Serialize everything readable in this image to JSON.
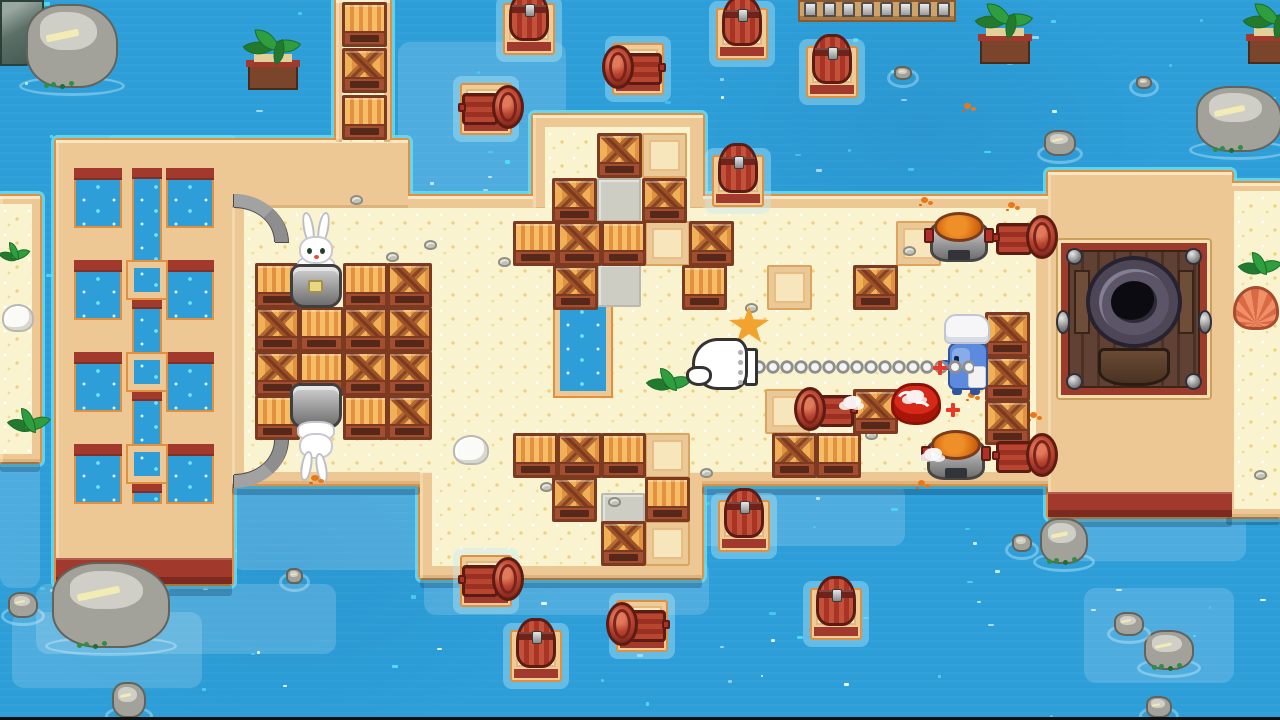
{
  "scene": {
    "w": 1280,
    "h": 720,
    "name": "beach-arena-map",
    "letterbox_bottom": 3
  },
  "palette": {
    "water": "#2d9ed8",
    "water_sparkle": "#4fdef6",
    "water_sparkle_white": "#eafcff",
    "aqua_rim": "rgba(108,220,240,0.85)",
    "outline_orange": "#e0903e",
    "tan": "#edc794",
    "sand": "#faf3d0",
    "dark_red": "#a13a2c",
    "crate_frame": "#7c3a20",
    "crate_light": "#f4bd66",
    "crate_dark": "#e39140",
    "barrel_red": "#a93426",
    "grey_tile": "#cdcdc3",
    "metal": "#9e9e9e"
  },
  "ocean": {
    "sparkle_count": 175,
    "seed": 13
  },
  "shallows": [
    [
      36,
      584,
      300,
      70
    ],
    [
      12,
      612,
      190,
      76
    ],
    [
      424,
      560,
      285,
      55
    ],
    [
      1046,
      506,
      200,
      55
    ],
    [
      1084,
      588,
      150,
      95
    ],
    [
      398,
      42,
      168,
      150
    ],
    [
      232,
      470,
      205,
      100
    ],
    [
      690,
      484,
      215,
      62
    ],
    [
      0,
      458,
      40,
      130
    ]
  ],
  "land": {
    "shapes": [
      {
        "n": "main-island",
        "x": 232,
        "y": 196,
        "w": 816,
        "h": 288
      },
      {
        "n": "bridge-band",
        "x": 112,
        "y": 140,
        "w": 296,
        "h": 68
      },
      {
        "n": "upper-block",
        "x": 533,
        "y": 115,
        "w": 170,
        "h": 95
      },
      {
        "n": "lower-block",
        "x": 420,
        "y": 470,
        "w": 282,
        "h": 108
      },
      {
        "n": "top-column",
        "x": 336,
        "y": 0,
        "w": 54,
        "h": 142
      },
      {
        "n": "left-strip",
        "x": 0,
        "y": 196,
        "w": 40,
        "h": 266
      },
      {
        "n": "right-path",
        "x": 1226,
        "y": 183,
        "w": 54,
        "h": 334
      },
      {
        "n": "left-pier",
        "x": 56,
        "y": 140,
        "w": 176,
        "h": 444
      },
      {
        "n": "right-platform",
        "x": 1048,
        "y": 172,
        "w": 184,
        "h": 345
      }
    ],
    "cream": [
      {
        "n": "top-column-sand",
        "x": 342,
        "y": 0,
        "w": 42,
        "h": 142
      },
      {
        "n": "upper-block-sand",
        "x": 545,
        "y": 127,
        "w": 145,
        "h": 85
      },
      {
        "n": "main-island-sand",
        "x": 244,
        "y": 208,
        "w": 792,
        "h": 264
      },
      {
        "n": "lower-block-sand",
        "x": 432,
        "y": 470,
        "w": 258,
        "h": 96
      },
      {
        "n": "right-path-sand",
        "x": 1234,
        "y": 191,
        "w": 46,
        "h": 318
      },
      {
        "n": "left-strip-sand",
        "x": 0,
        "y": 204,
        "w": 32,
        "h": 250
      }
    ]
  },
  "pier": {
    "x": 56,
    "y": 140,
    "hole_w": 48,
    "hole_h": 60,
    "holes": [
      [
        18,
        28
      ],
      [
        18,
        120
      ],
      [
        18,
        212
      ],
      [
        18,
        304
      ],
      [
        110,
        28
      ],
      [
        110,
        120
      ],
      [
        110,
        212
      ],
      [
        110,
        304
      ]
    ],
    "channel": [
      76,
      28,
      30,
      336
    ],
    "nodes": [
      [
        70,
        120
      ],
      [
        70,
        212
      ],
      [
        70,
        304
      ]
    ],
    "node_w": 42,
    "node_h": 40,
    "base": [
      0,
      418,
      176,
      26
    ]
  },
  "pool": {
    "x": 553,
    "y": 288,
    "w": 60,
    "h": 110
  },
  "platform": {
    "x": 1048,
    "y": 172,
    "w": 184,
    "h": 345,
    "base": [
      0,
      320,
      184,
      25
    ],
    "pit": {
      "x": 10,
      "y": 68,
      "w": 152,
      "h": 158
    }
  },
  "dock": {
    "x": 798,
    "y": 0,
    "w": 158,
    "h": 22,
    "posts": 8
  },
  "shadows": [
    [
      56,
      584,
      176,
      12
    ],
    [
      1048,
      517,
      184,
      10
    ],
    [
      420,
      578,
      282,
      10
    ],
    [
      232,
      486,
      188,
      9
    ],
    [
      702,
      486,
      346,
      9
    ],
    [
      1226,
      517,
      54,
      8
    ],
    [
      0,
      462,
      40,
      10
    ]
  ],
  "crates": [
    [
      342,
      2,
      "s"
    ],
    [
      342,
      48,
      "x"
    ],
    [
      342,
      95,
      "s"
    ],
    [
      255,
      263,
      "s"
    ],
    [
      343,
      263,
      "s"
    ],
    [
      387,
      263,
      "x"
    ],
    [
      255,
      307,
      "x"
    ],
    [
      299,
      307,
      "s"
    ],
    [
      343,
      307,
      "x"
    ],
    [
      387,
      307,
      "x"
    ],
    [
      255,
      351,
      "x"
    ],
    [
      299,
      351,
      "s"
    ],
    [
      343,
      351,
      "x"
    ],
    [
      387,
      351,
      "x"
    ],
    [
      255,
      395,
      "s"
    ],
    [
      343,
      395,
      "s"
    ],
    [
      387,
      395,
      "x"
    ],
    [
      597,
      133,
      "x"
    ],
    [
      552,
      178,
      "x"
    ],
    [
      642,
      178,
      "x"
    ],
    [
      513,
      221,
      "s"
    ],
    [
      557,
      221,
      "x"
    ],
    [
      601,
      221,
      "s"
    ],
    [
      689,
      221,
      "x"
    ],
    [
      553,
      265,
      "x"
    ],
    [
      682,
      265,
      "s"
    ],
    [
      853,
      265,
      "x"
    ],
    [
      985,
      312,
      "x"
    ],
    [
      985,
      356,
      "x"
    ],
    [
      985,
      400,
      "x"
    ],
    [
      853,
      389,
      "x"
    ],
    [
      772,
      433,
      "x"
    ],
    [
      816,
      433,
      "s"
    ],
    [
      513,
      433,
      "s"
    ],
    [
      557,
      433,
      "x"
    ],
    [
      601,
      433,
      "s"
    ],
    [
      552,
      477,
      "x"
    ],
    [
      645,
      477,
      "s"
    ],
    [
      601,
      521,
      "x"
    ]
  ],
  "tiles_empty": [
    [
      642,
      133
    ],
    [
      645,
      221
    ],
    [
      767,
      265
    ],
    [
      765,
      389
    ],
    [
      645,
      433
    ],
    [
      645,
      521
    ],
    [
      896,
      221
    ]
  ],
  "tiles_grey": [
    [
      597,
      178
    ],
    [
      597,
      263
    ],
    [
      601,
      493
    ]
  ],
  "rafts": [
    [
      503,
      3,
      "up"
    ],
    [
      716,
      8,
      "up"
    ],
    [
      806,
      46,
      "up"
    ],
    [
      612,
      43,
      "left"
    ],
    [
      460,
      83,
      "right"
    ],
    [
      712,
      155,
      "up"
    ],
    [
      718,
      500,
      "up"
    ],
    [
      510,
      630,
      "up"
    ],
    [
      810,
      588,
      "up"
    ],
    [
      460,
      555,
      "right"
    ],
    [
      616,
      600,
      "left"
    ]
  ],
  "barrels_side": [
    [
      990,
      215,
      "right"
    ],
    [
      990,
      433,
      "right"
    ],
    [
      796,
      387,
      "left"
    ]
  ],
  "pots": [
    [
      928,
      212
    ],
    [
      925,
      430
    ]
  ],
  "characters": {
    "rabbits": [
      {
        "x": 289,
        "y": 212,
        "flip": false
      },
      {
        "x": 289,
        "y": 383,
        "flip": true
      }
    ],
    "chef": {
      "x": 938,
      "y": 314
    },
    "crab": {
      "x": 889,
      "y": 379
    },
    "glove": {
      "x": 686,
      "y": 336,
      "chain_x": 752,
      "chain_w": 222,
      "chain_y": 354
    }
  },
  "rocks": [
    [
      26,
      4,
      92,
      84,
      "big"
    ],
    [
      1196,
      86,
      86,
      66,
      "big"
    ],
    [
      52,
      562,
      118,
      86,
      "big"
    ],
    [
      1040,
      518,
      48,
      46,
      "med"
    ],
    [
      1144,
      630,
      50,
      40,
      "med"
    ],
    [
      1044,
      130,
      32,
      26,
      "small"
    ],
    [
      8,
      592,
      30,
      26,
      "small"
    ],
    [
      112,
      682,
      34,
      36,
      "small"
    ],
    [
      1114,
      612,
      30,
      24,
      "small"
    ],
    [
      1146,
      696,
      26,
      22,
      "small"
    ],
    [
      1136,
      76,
      16,
      13,
      "tiny"
    ],
    [
      894,
      66,
      18,
      14,
      "tiny"
    ],
    [
      286,
      568,
      17,
      16,
      "tiny"
    ],
    [
      1012,
      534,
      20,
      18,
      "tiny"
    ]
  ],
  "corner_rock": [
    0,
    0,
    44,
    66
  ],
  "planters": [
    [
      246,
      28
    ],
    [
      978,
      2
    ],
    [
      1246,
      2
    ]
  ],
  "sprouts": [
    [
      650,
      368,
      40,
      38
    ],
    [
      2,
      242,
      26,
      30
    ],
    [
      12,
      408,
      36,
      42
    ],
    [
      1242,
      252,
      38,
      38
    ]
  ],
  "shells": [
    [
      453,
      435,
      36,
      30
    ],
    [
      2,
      304,
      32,
      28
    ],
    [
      4,
      33,
      26,
      28
    ]
  ],
  "scallop": [
    1233,
    286,
    46,
    44
  ],
  "starfish": [
    728,
    306,
    42,
    40
  ],
  "pebbles": [
    [
      386,
      252
    ],
    [
      498,
      257
    ],
    [
      668,
      201
    ],
    [
      540,
      482
    ],
    [
      608,
      497
    ],
    [
      745,
      303
    ],
    [
      700,
      468
    ],
    [
      865,
      430
    ],
    [
      903,
      246
    ],
    [
      1254,
      470
    ],
    [
      350,
      195
    ],
    [
      424,
      240
    ]
  ],
  "splats": [
    [
      921,
      197
    ],
    [
      1008,
      202
    ],
    [
      968,
      392
    ],
    [
      1030,
      412
    ],
    [
      918,
      480
    ],
    [
      964,
      103
    ]
  ],
  "puffs": [
    [
      843,
      396
    ],
    [
      906,
      390
    ],
    [
      924,
      448
    ]
  ],
  "red_sparks": [
    [
      938,
      366
    ],
    [
      951,
      408
    ]
  ],
  "pipes": [
    {
      "x": 234,
      "y": 194,
      "dir": "up"
    },
    {
      "x": 234,
      "y": 440,
      "dir": "down"
    }
  ]
}
